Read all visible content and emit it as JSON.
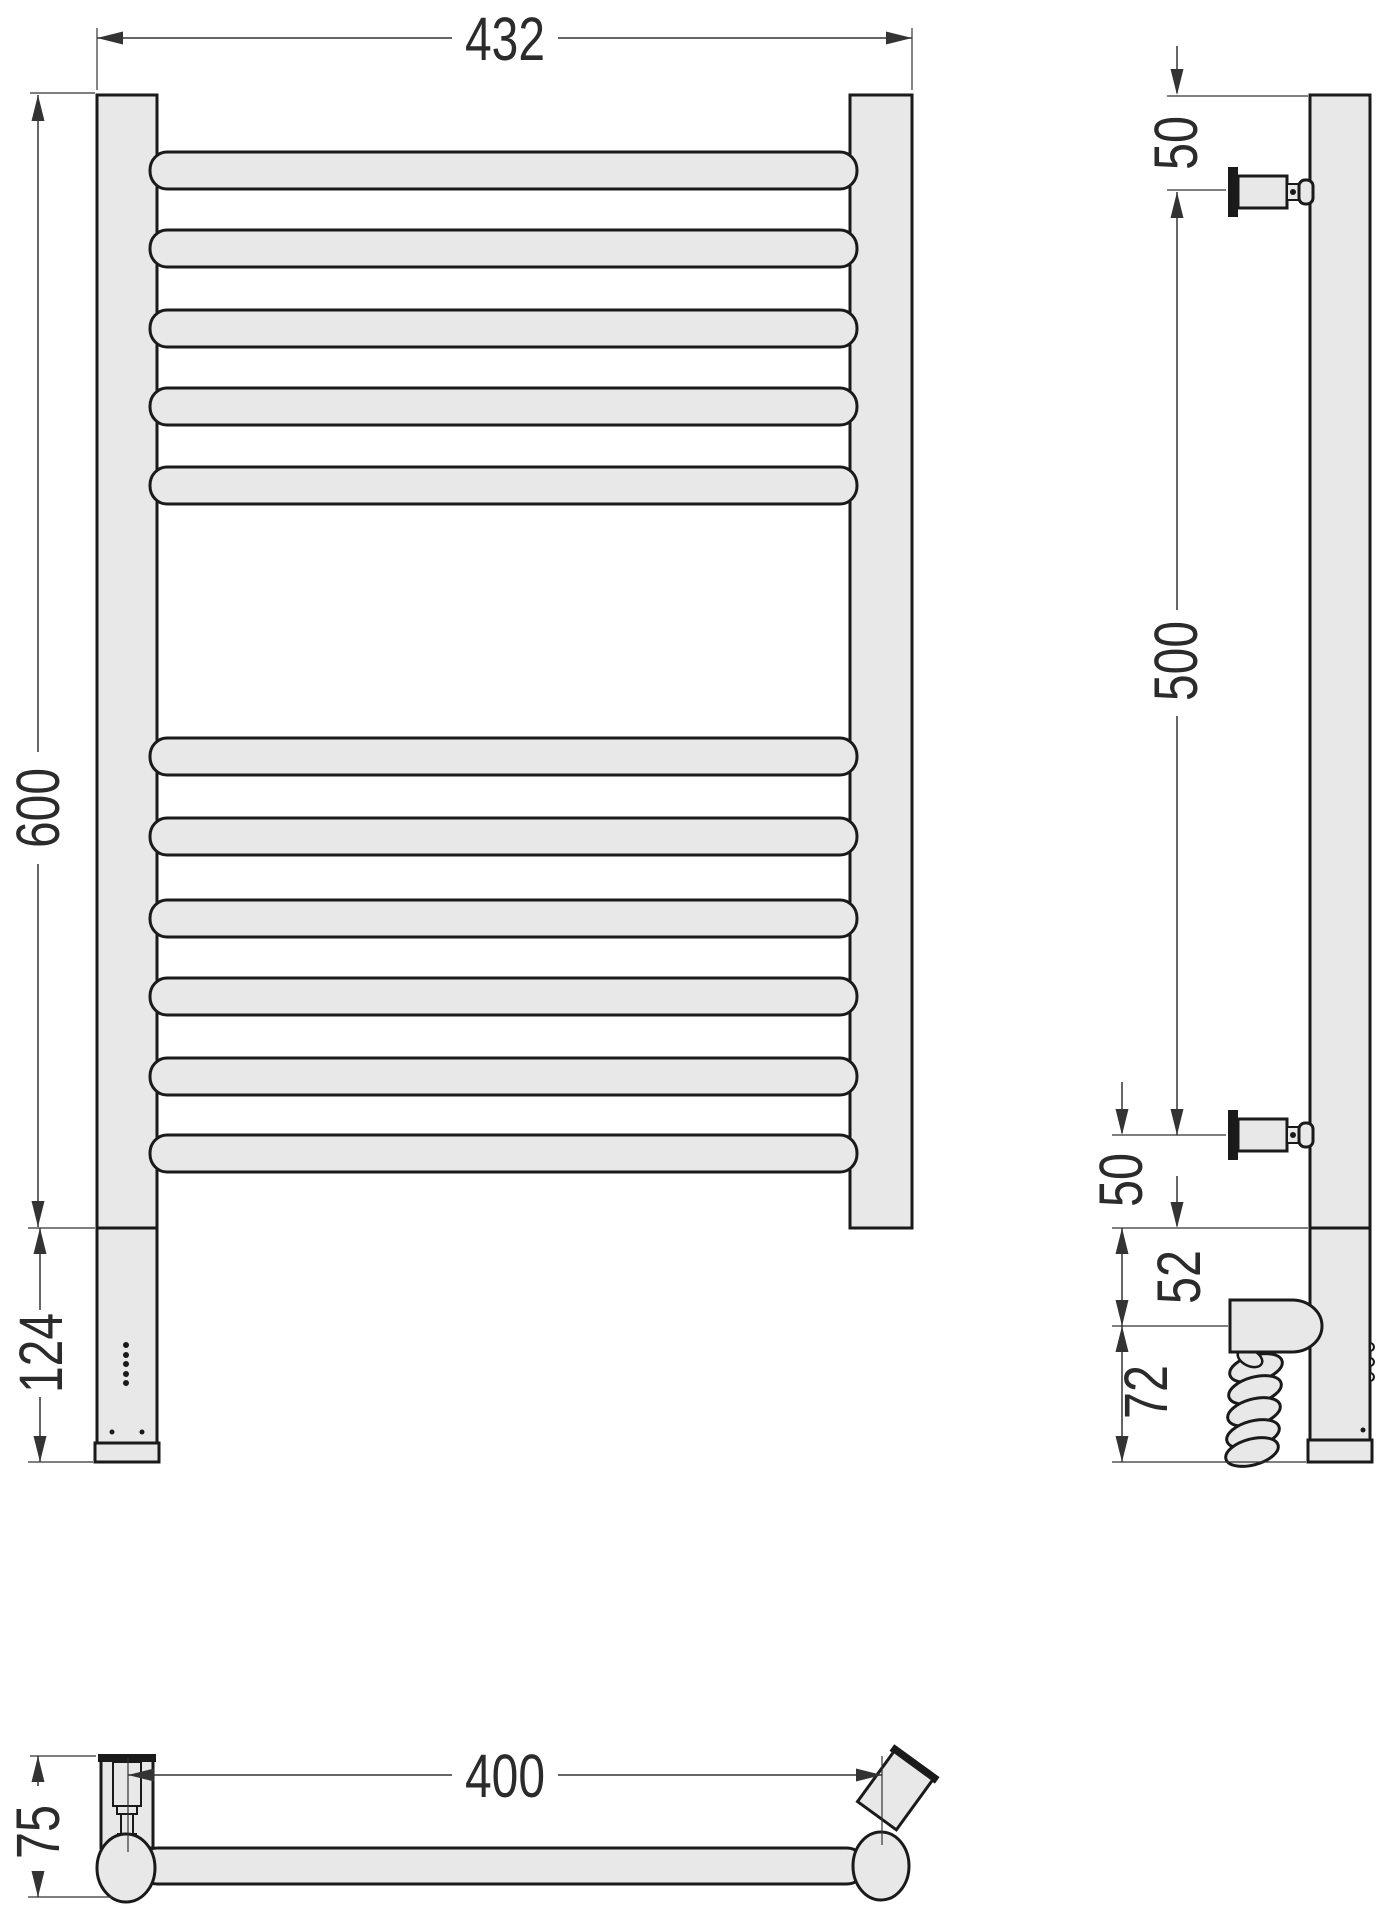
{
  "title": "Heated towel rail dimension drawing",
  "colors": {
    "background": "#ffffff",
    "part_fill": "#e8e8e8",
    "outline": "#1a1a1a",
    "dimension_lines": "#333333",
    "dimension_text": "#2b2b2b"
  },
  "dims": {
    "front_width": "432",
    "front_height": "600",
    "front_bottom_section": "124",
    "side_top_offset": "50",
    "side_bracket_span": "500",
    "side_bottom_offset": "50",
    "side_heater_gap": "52",
    "side_heater_zone": "72",
    "bottom_bracket_span": "400",
    "bottom_depth": "75"
  },
  "front_view": {
    "bar_count": 11,
    "bar_tops": [
      152,
      230,
      310,
      388,
      467,
      738,
      818,
      900,
      978,
      1058,
      1135
    ],
    "bar_height": 37,
    "indicator_dots": 5,
    "fixing_dots": 2
  },
  "side_view": {
    "bracket_centers_y": [
      192,
      1135
    ],
    "coil_loops": 5
  }
}
